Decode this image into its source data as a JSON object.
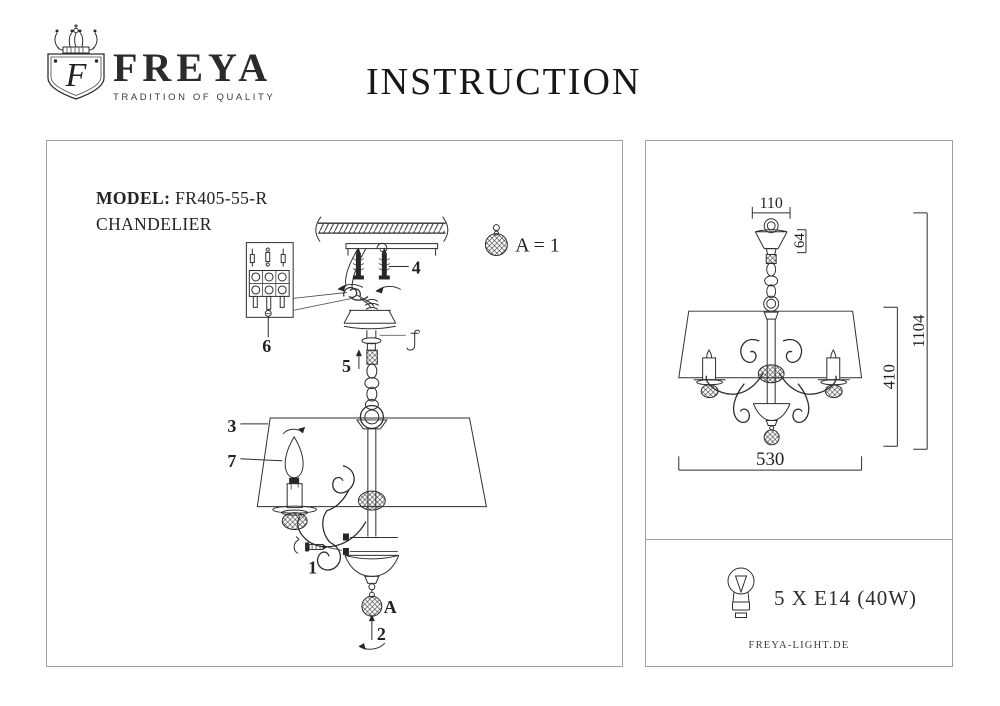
{
  "header": {
    "brand": "FREYA",
    "tagline": "TRADITION OF QUALITY",
    "monogram": "F",
    "title": "INSTRUCTION"
  },
  "product": {
    "model_label": "MODEL:",
    "model": "FR405-55-R",
    "type": "CHANDELIER"
  },
  "assembly": {
    "note": "A = 1",
    "labels": {
      "n1": "1",
      "n2": "2",
      "n3": "3",
      "n4": "4",
      "n5": "5",
      "n6": "6",
      "n7": "7",
      "a": "A"
    }
  },
  "dimensions": {
    "canopy_width": "110",
    "canopy_height": "64",
    "total_height": "1104",
    "body_height": "410",
    "shade_width": "530"
  },
  "specs": {
    "lamp": "5 X E14 (40W)",
    "website": "FREYA-LIGHT.DE"
  },
  "colors": {
    "ink": "#2e2e2e",
    "frame": "#a0a0a0"
  }
}
